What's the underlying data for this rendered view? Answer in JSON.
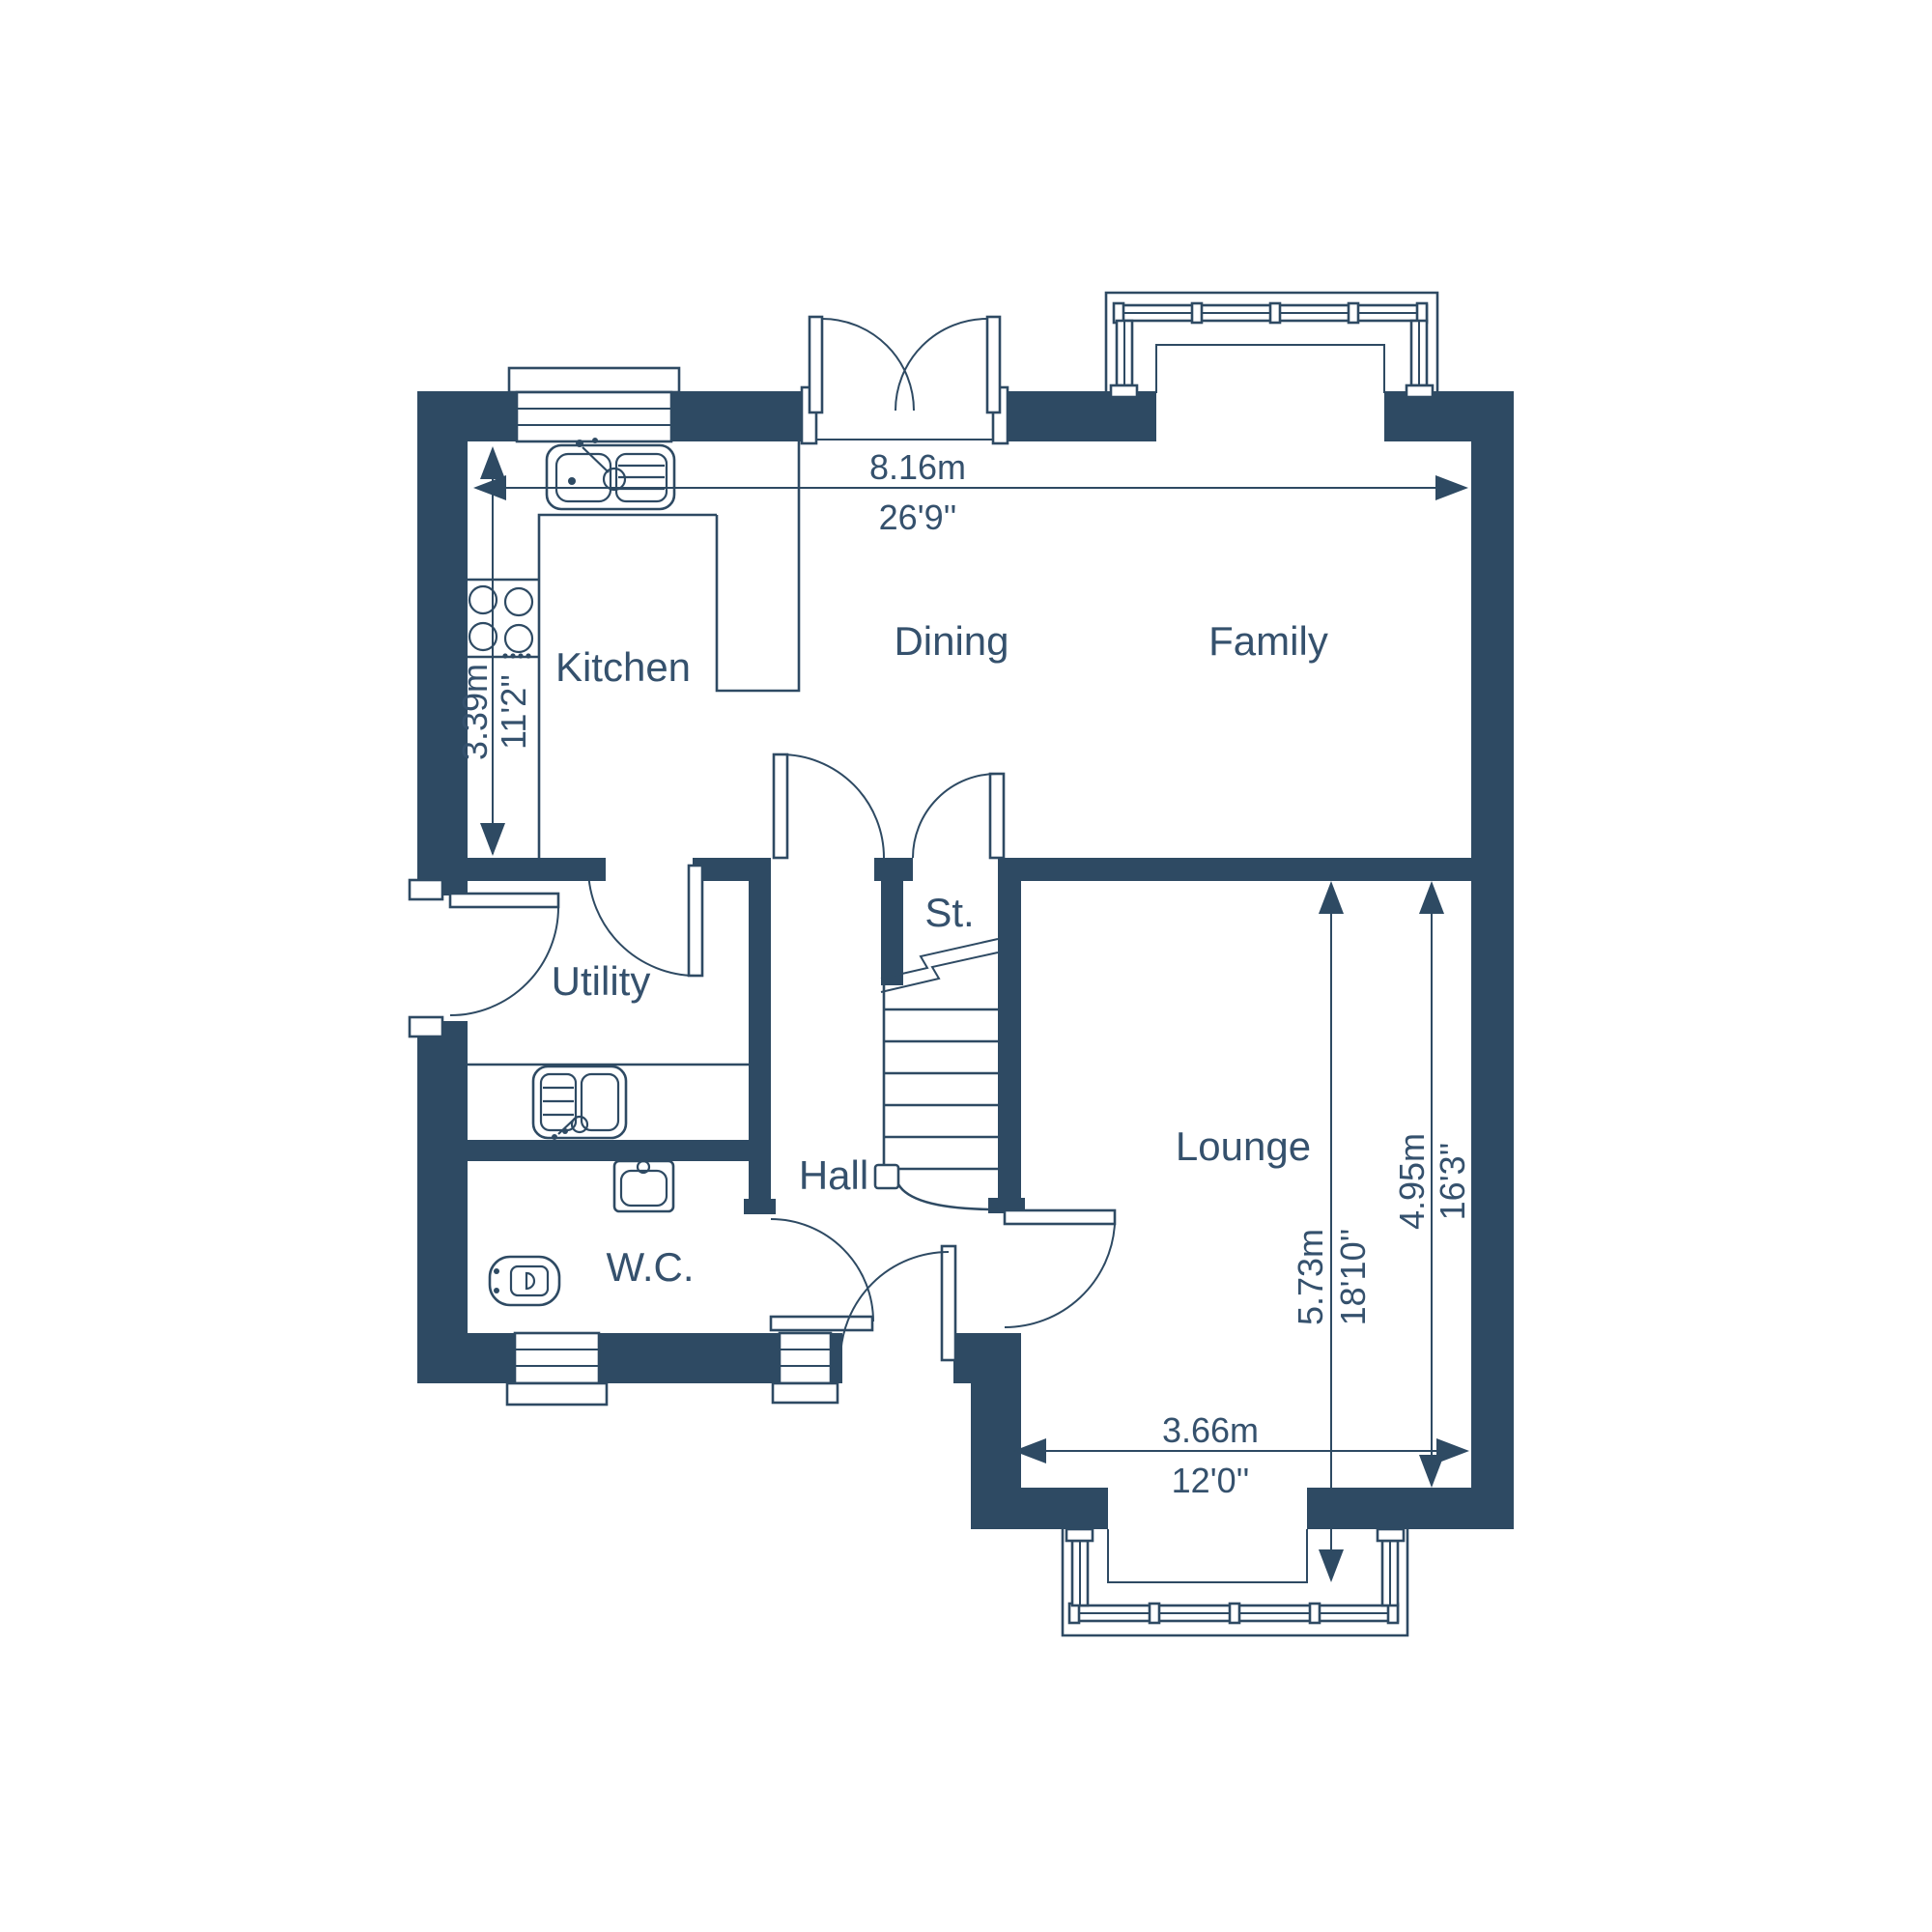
{
  "plan": {
    "type": "floor-plan",
    "background": "#ffffff"
  },
  "colors": {
    "wall": "#2e4a63",
    "line": "#2e4a63",
    "text": "#35516d",
    "background": "#ffffff"
  },
  "rooms": {
    "kitchen": {
      "label": "Kitchen"
    },
    "dining": {
      "label": "Dining"
    },
    "family": {
      "label": "Family"
    },
    "utility": {
      "label": "Utility"
    },
    "store": {
      "label": "St."
    },
    "hall": {
      "label": "Hall"
    },
    "wc": {
      "label": "W.C."
    },
    "lounge": {
      "label": "Lounge"
    }
  },
  "dimensions": {
    "overall_width": {
      "metric": "8.16m",
      "imperial": "26'9''"
    },
    "kitchen_depth": {
      "metric": "3.39m",
      "imperial": "11'2''"
    },
    "lounge_depth_overall": {
      "metric": "5.73m",
      "imperial": "18'10''"
    },
    "lounge_depth": {
      "metric": "4.95m",
      "imperial": "16'3''"
    },
    "lounge_width": {
      "metric": "3.66m",
      "imperial": "12'0''"
    }
  }
}
